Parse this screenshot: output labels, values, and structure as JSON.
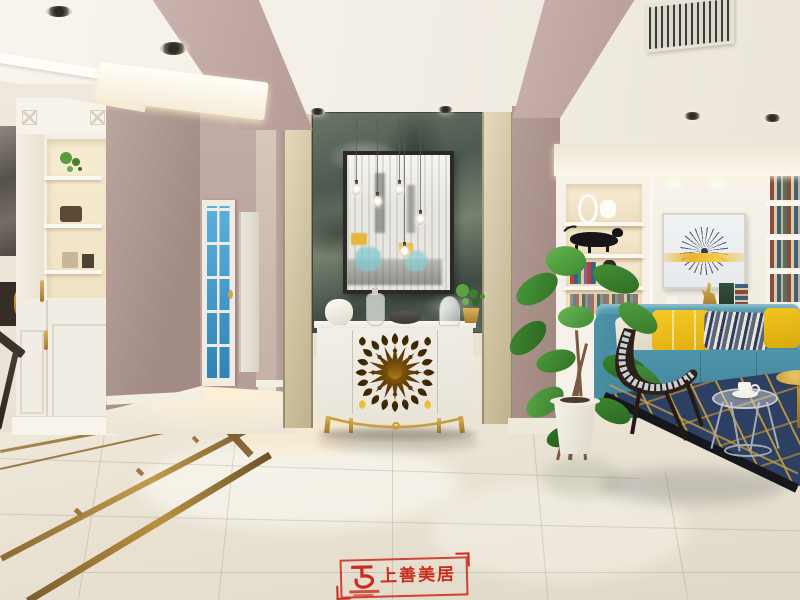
{
  "scene": {
    "type": "interior-photograph",
    "view": "entry hall with green marble feature wall and gold-medallion sideboard; hallway with blue glass door at left; living room with teal sofa, built-in bookshelves and navy rug at right",
    "palette": {
      "wall_mauve": "#ab928c",
      "ceiling_white": "#f4f0e8",
      "marble_green_gray": "#5d685e",
      "champagne_trim": "#d5c9a8",
      "gold_accent": "#c49a3e",
      "sofa_teal": "#4b90a5",
      "pillow_yellow": "#f2c51e",
      "rug_navy": "#2d3f63",
      "floor_cream": "#eae3d4",
      "door_glass_blue": "#3e9bce"
    }
  },
  "watermark": {
    "brand_name": "上善美居",
    "color": "#cc2a1c"
  }
}
